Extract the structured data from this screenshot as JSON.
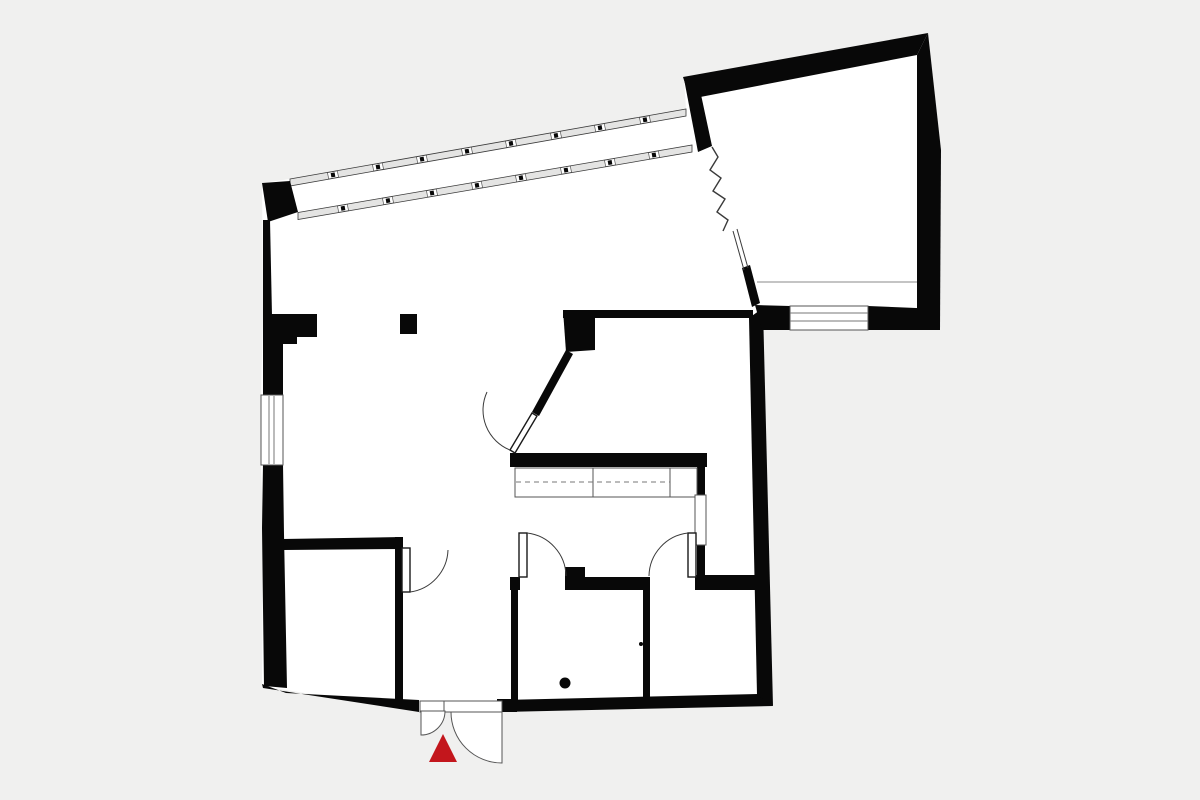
{
  "meta": {
    "description": "Black and white architectural floor plan on light grey background with red entrance marker triangle",
    "canvas": {
      "width": 1200,
      "height": 800
    }
  },
  "colors": {
    "background": "#f0f0ef",
    "floor": "#ffffff",
    "wall": "#080808",
    "thin_line": "#3a3a3a",
    "mid_line": "#555555",
    "light_line": "#8a8a8a",
    "band_fill": "#e4e4e3",
    "entrance_marker": "#c3161c"
  },
  "floor_outline": {
    "name": "building-floor",
    "points": [
      [
        262,
        183
      ],
      [
        290,
        179
      ],
      [
        686,
        109
      ],
      [
        684,
        78
      ],
      [
        928,
        33
      ],
      [
        941,
        150
      ],
      [
        940,
        330
      ],
      [
        763,
        330
      ],
      [
        773,
        706
      ],
      [
        500,
        712
      ],
      [
        420,
        712
      ],
      [
        262,
        686
      ],
      [
        263,
        528
      ],
      [
        261,
        465
      ],
      [
        261,
        395
      ],
      [
        263,
        315
      ]
    ]
  },
  "window_bands": [
    {
      "name": "curtain-wall-upper",
      "x1": 290,
      "y1": 182.5,
      "x2": 686,
      "y2": 112.5,
      "width": 7,
      "mullions": [
        333,
        378,
        422,
        467,
        511,
        556,
        600,
        645
      ]
    },
    {
      "name": "curtain-wall-lower",
      "x1": 298,
      "y1": 216,
      "x2": 692,
      "y2": 148.5,
      "width": 7,
      "mullions": [
        343,
        388,
        432,
        477,
        521,
        566,
        610,
        654
      ]
    }
  ],
  "walls": [
    {
      "name": "wall-corner-block-top-left",
      "type": "polygon",
      "points": [
        [
          262,
          183
        ],
        [
          290,
          181
        ],
        [
          298,
          212
        ],
        [
          268,
          222
        ]
      ]
    },
    {
      "name": "wall-left-upper",
      "type": "polygon",
      "points": [
        [
          263,
          220
        ],
        [
          270,
          220
        ],
        [
          272,
          316
        ],
        [
          263,
          316
        ]
      ]
    },
    {
      "name": "wall-left-pier",
      "type": "polygon",
      "points": [
        [
          263,
          314
        ],
        [
          317,
          314
        ],
        [
          317,
          337
        ],
        [
          297,
          337
        ],
        [
          297,
          344
        ],
        [
          263,
          344
        ]
      ]
    },
    {
      "name": "wall-left-mid",
      "type": "polygon",
      "points": [
        [
          263,
          342
        ],
        [
          283,
          342
        ],
        [
          283,
          396
        ],
        [
          263,
          396
        ]
      ]
    },
    {
      "name": "wall-left-lower",
      "type": "polygon",
      "points": [
        [
          263,
          464
        ],
        [
          283,
          464
        ],
        [
          284,
          534
        ],
        [
          287,
          688
        ],
        [
          264,
          686
        ],
        [
          262,
          528
        ]
      ]
    },
    {
      "name": "wall-bottom-left",
      "type": "polygon",
      "points": [
        [
          262,
          684
        ],
        [
          286,
          693
        ],
        [
          419,
          700
        ],
        [
          419,
          712
        ],
        [
          263,
          688
        ]
      ]
    },
    {
      "name": "wall-bottom-right",
      "type": "polygon",
      "points": [
        [
          500,
          700
        ],
        [
          758,
          694
        ],
        [
          773,
          706
        ],
        [
          500,
          712
        ]
      ]
    },
    {
      "name": "wall-right-main",
      "type": "polygon",
      "points": [
        [
          763,
          308
        ],
        [
          773,
          706
        ],
        [
          757,
          695
        ],
        [
          749,
          318
        ]
      ]
    },
    {
      "name": "wall-sill-left-part",
      "type": "polygon",
      "points": [
        [
          755,
          305
        ],
        [
          790,
          306
        ],
        [
          790,
          330
        ],
        [
          762,
          330
        ]
      ]
    },
    {
      "name": "wall-sill-right-part",
      "type": "polygon",
      "points": [
        [
          868,
          306
        ],
        [
          940,
          309
        ],
        [
          940,
          330
        ],
        [
          868,
          330
        ]
      ]
    },
    {
      "name": "wall-upper-room-top",
      "type": "polygon",
      "points": [
        [
          683,
          77
        ],
        [
          928,
          33
        ],
        [
          917,
          55
        ],
        [
          690,
          99
        ]
      ]
    },
    {
      "name": "wall-upper-room-right",
      "type": "polygon",
      "points": [
        [
          928,
          33
        ],
        [
          941,
          150
        ],
        [
          940,
          330
        ],
        [
          917,
          310
        ],
        [
          917,
          55
        ]
      ]
    },
    {
      "name": "wall-band-end-pier",
      "type": "polygon",
      "points": [
        [
          684,
          79
        ],
        [
          697,
          76
        ],
        [
          712,
          146
        ],
        [
          698,
          152
        ]
      ]
    },
    {
      "name": "wall-upper-room-left-lower",
      "type": "polygon",
      "points": [
        [
          742,
          268
        ],
        [
          750,
          265
        ],
        [
          760,
          303
        ],
        [
          752,
          307
        ]
      ]
    },
    {
      "name": "wall-middle-room-top",
      "type": "polygon",
      "points": [
        [
          563,
          310
        ],
        [
          753,
          310
        ],
        [
          753,
          318
        ],
        [
          563,
          318
        ]
      ]
    },
    {
      "name": "wall-middle-room-corner-block",
      "type": "polygon",
      "points": [
        [
          563,
          310
        ],
        [
          595,
          310
        ],
        [
          595,
          350
        ],
        [
          566,
          352
        ]
      ]
    },
    {
      "name": "wall-middle-room-diagonal",
      "type": "polygon",
      "points": [
        [
          566,
          350
        ],
        [
          573,
          354
        ],
        [
          539,
          416
        ],
        [
          532,
          412
        ]
      ]
    },
    {
      "name": "wall-middle-room-bottom",
      "type": "polygon",
      "points": [
        [
          510,
          453
        ],
        [
          707,
          453
        ],
        [
          707,
          467
        ],
        [
          510,
          467
        ]
      ]
    },
    {
      "name": "wall-pantry-upper",
      "type": "rect",
      "x": 697,
      "y": 465,
      "w": 8,
      "h": 31
    },
    {
      "name": "wall-pantry-lower",
      "type": "rect",
      "x": 697,
      "y": 544,
      "w": 8,
      "h": 45
    },
    {
      "name": "wall-kitchen-bottom-a",
      "type": "rect",
      "x": 510,
      "y": 577,
      "w": 10,
      "h": 13
    },
    {
      "name": "wall-kitchen-bottom-b",
      "type": "rect",
      "x": 565,
      "y": 577,
      "w": 85,
      "h": 13
    },
    {
      "name": "wall-kitchen-bottom-c",
      "type": "rect",
      "x": 695,
      "y": 575,
      "w": 62,
      "h": 15
    },
    {
      "name": "pier-kitchen-column",
      "type": "rect",
      "x": 565,
      "y": 567,
      "w": 20,
      "h": 15
    },
    {
      "name": "wall-bottom-rooms-divider",
      "type": "rect",
      "x": 643,
      "y": 582,
      "w": 7,
      "h": 118
    },
    {
      "name": "wall-bottom-left-room-top",
      "type": "polygon",
      "points": [
        [
          283,
          539
        ],
        [
          403,
          537
        ],
        [
          403,
          549
        ],
        [
          283,
          550
        ]
      ]
    },
    {
      "name": "wall-bottom-left-room-right",
      "type": "rect",
      "x": 395,
      "y": 537,
      "w": 8,
      "h": 163
    },
    {
      "name": "wall-bottom-middle-room-left",
      "type": "rect",
      "x": 511,
      "y": 580,
      "w": 7,
      "h": 120
    },
    {
      "name": "jamb-entrance-right",
      "type": "rect",
      "x": 497,
      "y": 699,
      "w": 20,
      "h": 13
    },
    {
      "name": "column-main-hall",
      "type": "rect",
      "x": 400,
      "y": 314,
      "w": 17,
      "h": 20
    }
  ],
  "features": [
    {
      "name": "window-left-wall",
      "type": "rect",
      "x": 261,
      "y": 395,
      "w": 22,
      "h": 70,
      "fill": "#ffffff",
      "stroke": "#555555",
      "sw": 1
    },
    {
      "name": "window-left-wall-pane-line-1",
      "type": "line",
      "x1": 269,
      "y1": 396,
      "x2": 269,
      "y2": 464,
      "stroke": "#777777",
      "sw": 1
    },
    {
      "name": "window-left-wall-pane-line-2",
      "type": "line",
      "x1": 274,
      "y1": 396,
      "x2": 274,
      "y2": 464,
      "stroke": "#777777",
      "sw": 1
    },
    {
      "name": "window-upper-room",
      "type": "rect",
      "x": 790,
      "y": 306,
      "w": 78,
      "h": 24,
      "fill": "#ffffff",
      "stroke": "#555555",
      "sw": 1
    },
    {
      "name": "window-upper-room-pane-line-1",
      "type": "line",
      "x1": 790,
      "y1": 313,
      "x2": 868,
      "y2": 313,
      "stroke": "#777777",
      "sw": 1
    },
    {
      "name": "window-upper-room-pane-line-2",
      "type": "line",
      "x1": 790,
      "y1": 321,
      "x2": 868,
      "y2": 321,
      "stroke": "#777777",
      "sw": 1
    },
    {
      "name": "upper-room-interior-line",
      "type": "line",
      "x1": 757,
      "y1": 282,
      "x2": 917,
      "y2": 282,
      "stroke": "#8a8a8a",
      "sw": 1
    },
    {
      "name": "section-break-zigzag",
      "type": "polyline",
      "points": [
        [
          712,
          147
        ],
        [
          718,
          157
        ],
        [
          710,
          170
        ],
        [
          721,
          178
        ],
        [
          713,
          191
        ],
        [
          725,
          199
        ],
        [
          717,
          212
        ],
        [
          728,
          220
        ],
        [
          723,
          231
        ]
      ],
      "stroke": "#3a3a3a",
      "sw": 1.4
    },
    {
      "name": "section-cut-line-1",
      "type": "line",
      "x1": 733,
      "y1": 231,
      "x2": 744,
      "y2": 270,
      "stroke": "#3a3a3a",
      "sw": 1
    },
    {
      "name": "section-cut-line-2",
      "type": "line",
      "x1": 737,
      "y1": 229,
      "x2": 748,
      "y2": 268,
      "stroke": "#3a3a3a",
      "sw": 1
    },
    {
      "name": "kitchen-counter",
      "type": "rect",
      "x": 515,
      "y": 468,
      "w": 182,
      "h": 29,
      "fill": "#ffffff",
      "stroke": "#555555",
      "sw": 1
    },
    {
      "name": "kitchen-counter-divider-1",
      "type": "line",
      "x1": 593,
      "y1": 468,
      "x2": 593,
      "y2": 497,
      "stroke": "#555555",
      "sw": 1
    },
    {
      "name": "kitchen-counter-divider-2",
      "type": "line",
      "x1": 670,
      "y1": 468,
      "x2": 670,
      "y2": 497,
      "stroke": "#555555",
      "sw": 1
    },
    {
      "name": "kitchen-counter-dashed-line",
      "type": "line",
      "x1": 516,
      "y1": 482,
      "x2": 670,
      "y2": 482,
      "stroke": "#777777",
      "sw": 1,
      "dash": "5,4"
    },
    {
      "name": "sliding-door-pantry",
      "type": "rect",
      "x": 695,
      "y": 495,
      "w": 11,
      "h": 50,
      "fill": "#ffffff",
      "stroke": "#555555",
      "sw": 1
    },
    {
      "name": "door-leaf-middle-room",
      "type": "polygon",
      "points": [
        [
          532,
          413
        ],
        [
          537,
          416
        ],
        [
          515,
          453
        ],
        [
          510,
          450
        ]
      ],
      "fill": "#ffffff",
      "stroke": "#1a1a1a",
      "sw": 1.4
    },
    {
      "name": "door-arc-middle-room",
      "type": "path",
      "d": "M510,450 A43,43 0 0 1 487,392",
      "stroke": "#3a3a3a",
      "sw": 1
    },
    {
      "name": "door-leaf-bottom-left-room",
      "type": "rect",
      "x": 402,
      "y": 548,
      "w": 8,
      "h": 44,
      "fill": "#ffffff",
      "stroke": "#1a1a1a",
      "sw": 1.4
    },
    {
      "name": "door-arc-bottom-left-room",
      "type": "path",
      "d": "M410,592 A44,44 0 0 0 448,550",
      "stroke": "#3a3a3a",
      "sw": 1
    },
    {
      "name": "door-leaf-kitchen-left",
      "type": "rect",
      "x": 519,
      "y": 533,
      "w": 8,
      "h": 44,
      "fill": "#ffffff",
      "stroke": "#1a1a1a",
      "sw": 1.4
    },
    {
      "name": "door-arc-kitchen-left",
      "type": "path",
      "d": "M527,533 A44,44 0 0 1 566,576",
      "stroke": "#3a3a3a",
      "sw": 1
    },
    {
      "name": "door-leaf-kitchen-right",
      "type": "rect",
      "x": 688,
      "y": 533,
      "w": 8,
      "h": 44,
      "fill": "#ffffff",
      "stroke": "#1a1a1a",
      "sw": 1.4
    },
    {
      "name": "door-arc-kitchen-right",
      "type": "path",
      "d": "M688,533 A44,44 0 0 0 649,576",
      "stroke": "#3a3a3a",
      "sw": 1
    },
    {
      "name": "entrance-threshold",
      "type": "rect",
      "x": 420,
      "y": 701,
      "w": 82,
      "h": 11,
      "fill": "#ffffff",
      "stroke": "#555555",
      "sw": 1
    },
    {
      "name": "entrance-threshold-divider",
      "type": "line",
      "x1": 444,
      "y1": 701,
      "x2": 444,
      "y2": 712,
      "stroke": "#555555",
      "sw": 1
    },
    {
      "name": "entrance-door-swing-left",
      "type": "path",
      "d": "M421,711 L445,711 A24,24 0 0 1 421,735 Z",
      "fill": "#ffffff",
      "stroke": "#555555",
      "sw": 1
    },
    {
      "name": "entrance-door-swing-right",
      "type": "path",
      "d": "M502,712 L502,763 A51,51 0 0 1 451,712 Z",
      "fill": "#ffffff",
      "stroke": "#555555",
      "sw": 1
    },
    {
      "name": "entrance-marker-triangle",
      "type": "polygon",
      "points": [
        [
          443,
          734
        ],
        [
          429,
          762
        ],
        [
          457,
          762
        ]
      ],
      "fill": "#c3161c"
    },
    {
      "name": "floor-dot-large",
      "type": "circle",
      "cx": 565,
      "cy": 683,
      "r": 5.5,
      "fill": "#080808"
    },
    {
      "name": "floor-dot-small",
      "type": "circle",
      "cx": 641,
      "cy": 644,
      "r": 2,
      "fill": "#080808"
    }
  ]
}
